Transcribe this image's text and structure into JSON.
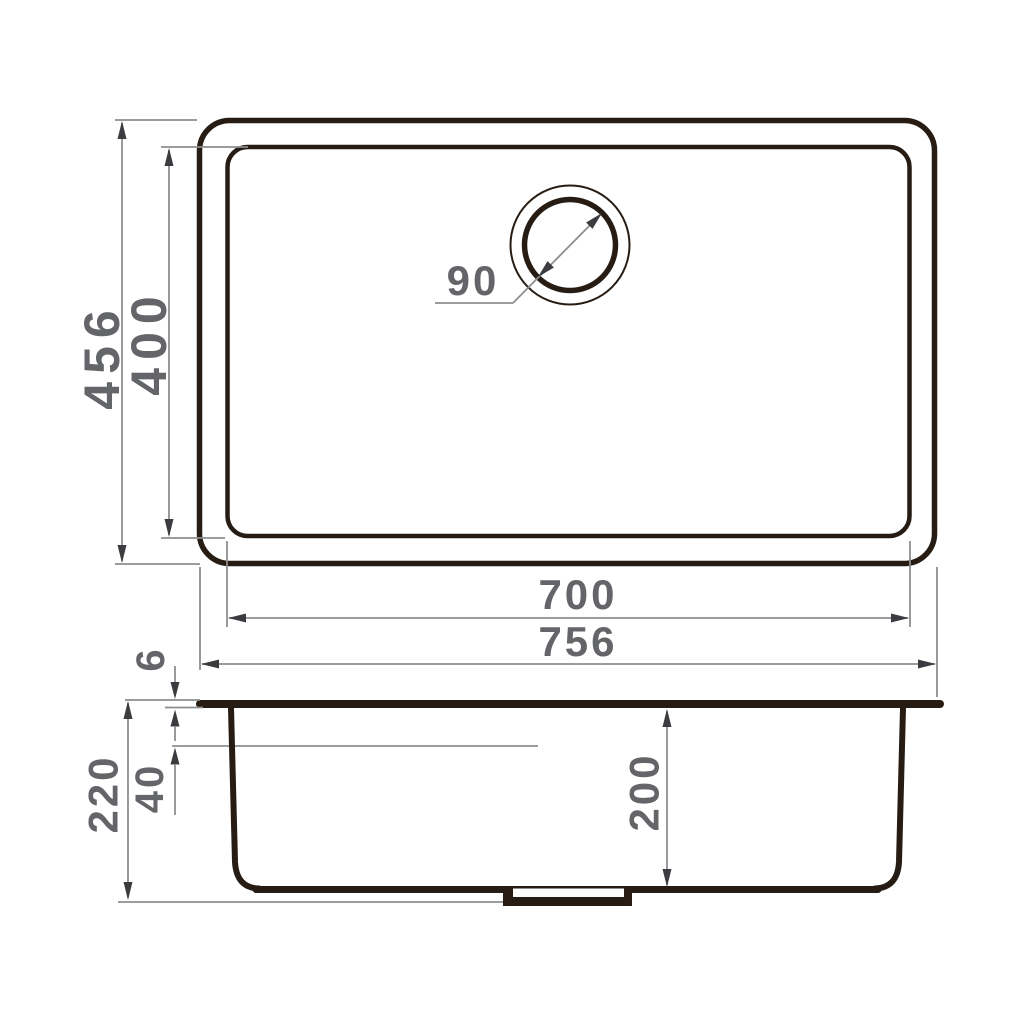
{
  "drawing": {
    "type": "technical-dimension-drawing",
    "subject": "undermount-kitchen-sink",
    "top_view": {
      "outer_width_mm": "756",
      "inner_width_mm": "700",
      "outer_depth_mm": "456",
      "inner_depth_mm": "400",
      "drain_diameter_mm": "90"
    },
    "section_view": {
      "overall_height_mm": "220",
      "bowl_inner_depth_mm": "200",
      "overflow_distance_mm": "40",
      "rim_thickness_mm": "6"
    },
    "colors": {
      "outline": "#261c13",
      "dimension_line": "#8d8e91",
      "dimension_text": "#646568",
      "arrowhead": "#3b3c3f",
      "background": "#ffffff"
    }
  }
}
